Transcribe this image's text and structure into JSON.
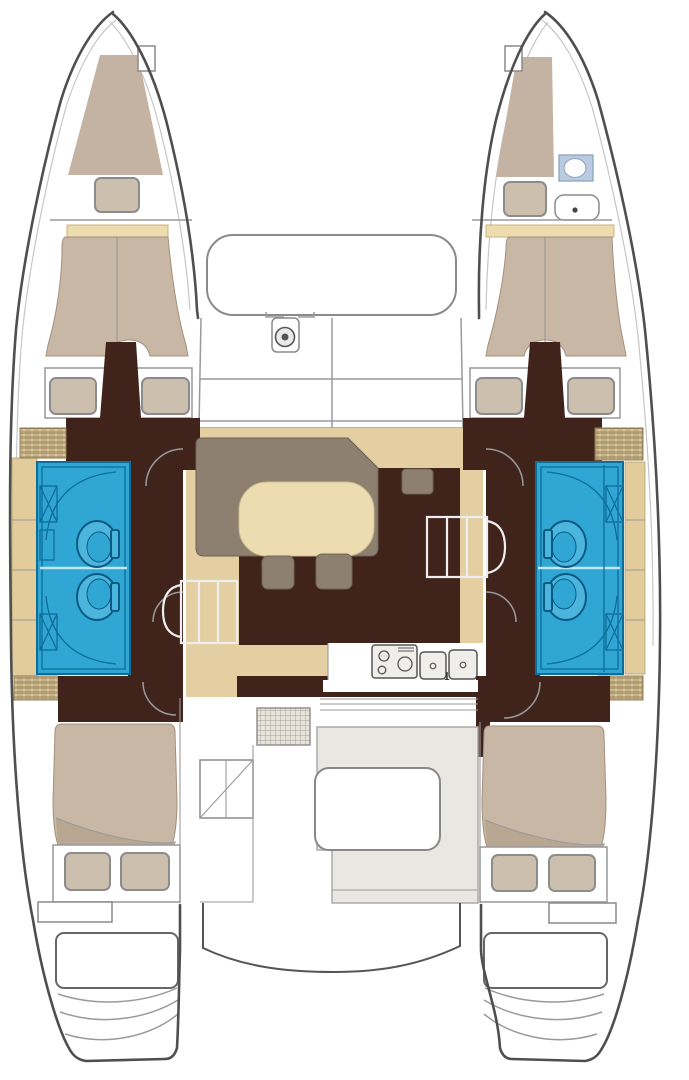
{
  "title": "Catamaran interior layout floor plan, bow up",
  "palette": {
    "hull-outline": "#4f4f4f",
    "line-soft": "#9a9a9a",
    "deck-tan": "#e3cfa2",
    "deck-tan-light": "#e2cc9c",
    "headboard": "#eddcad",
    "bed": "#c8b7a4",
    "bed-fold": "#b9a791",
    "pillow": "#cdbfae",
    "bow-berth": "#c4b3a2",
    "dark-wood": "#40241b",
    "sofa-brown": "#8d8071",
    "table-cream": "#eddcb0",
    "bath-blue": "#2fa6d3",
    "bath-blue-dark": "#0f6d99",
    "bath-blue-light": "#4cb5de",
    "toilet-panel-blue": "#b9cbe0",
    "bench-gray": "#e9e7e1",
    "fixture-white": "#efeeea"
  },
  "vessel": {
    "type": "catamaran",
    "orientation": "bow-up",
    "hulls": [
      "port",
      "starboard"
    ],
    "rooms": [
      {
        "id": "port-forepeak",
        "features": [
          "v-berth",
          "pillow"
        ]
      },
      {
        "id": "starboard-forepeak",
        "features": [
          "v-berth",
          "pillow",
          "toilet",
          "sink"
        ]
      },
      {
        "id": "port-forward-cabin",
        "features": [
          "double-berth",
          "pillow",
          "pillow"
        ]
      },
      {
        "id": "starboard-forward-cabin",
        "features": [
          "double-berth",
          "pillow",
          "pillow"
        ]
      },
      {
        "id": "port-heads",
        "features": [
          "toilet",
          "toilet",
          "shower",
          "shower",
          "seat-bench"
        ]
      },
      {
        "id": "starboard-heads",
        "features": [
          "toilet",
          "toilet",
          "shower",
          "shower",
          "seat-bench"
        ]
      },
      {
        "id": "saloon",
        "features": [
          "l-sofa",
          "dining-table",
          "stool",
          "stool",
          "side-table"
        ]
      },
      {
        "id": "galley",
        "features": [
          "stove-3-burner",
          "double-sink",
          "faucet"
        ]
      },
      {
        "id": "foredeck",
        "features": [
          "trampoline",
          "anchor-windlass",
          "deck-lockers"
        ]
      },
      {
        "id": "cockpit",
        "features": [
          "u-bench",
          "cockpit-table",
          "deck-grate",
          "sliding-door",
          "helm-seat"
        ]
      },
      {
        "id": "port-aft-cabin",
        "features": [
          "double-berth",
          "pillow",
          "pillow"
        ]
      },
      {
        "id": "starboard-aft-cabin",
        "features": [
          "double-berth",
          "pillow",
          "pillow"
        ]
      },
      {
        "id": "port-transom",
        "features": [
          "swim-platform",
          "steps"
        ]
      },
      {
        "id": "starboard-transom",
        "features": [
          "swim-platform",
          "steps"
        ]
      },
      {
        "id": "companionways",
        "features": [
          "port-steps",
          "starboard-steps"
        ]
      }
    ]
  }
}
